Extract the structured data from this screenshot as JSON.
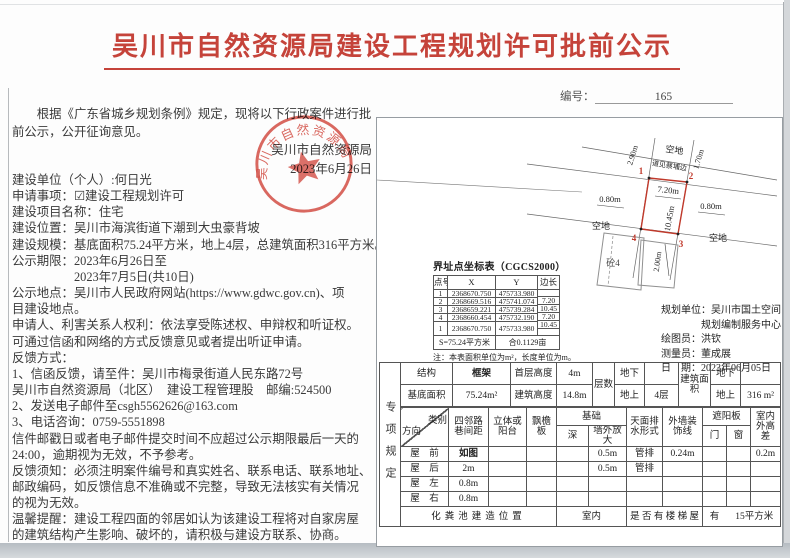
{
  "colors": {
    "title_red": "#c5433a",
    "seal_red": "#cf3a30",
    "parcel_red": "#c0392b",
    "table_line": "#555555"
  },
  "header": {
    "title": "吴川市自然资源局建设工程规划许可批前公示",
    "doc_no_label": "编号：",
    "doc_no_value": "165"
  },
  "body": {
    "intro": [
      "　　根据《广东省城乡规划条例》规定，现将以下行政案件进行批",
      "前公示，公开征询意见。"
    ],
    "signature": {
      "authority": "吴川市自然资源局",
      "date": "2023年6月26日"
    },
    "seal_arc_text": "吴川市自然资源局",
    "fields": [
      "建设单位（个人）:何日光",
      "申请事项：☑建设工程规划许可",
      "建设项目名称：住宅",
      "建设位置：吴川市海滨街道下潮到大虫豪背坡",
      "建设规模：基底面积75.24平方米，地上4层，总建筑面积316平方米。",
      "公示期限：2023年6月26日至",
      "　　　　　2023年7月5日(共10日)",
      "公示地点：吴川市人民政府网站(https://www.gdwc.gov.cn)、项",
      "目建设地点。",
      "申请人、利害关系人权利：依法享受陈述权、申辩权和听证权。",
      "可通过信函和网络的方式反馈意见或者提出听证申请。",
      "反馈方式：",
      "1、信函反馈，请至件：吴川市梅录街道人民东路72号",
      "吴川市自然资源局（北区）　建设工程管理股　邮编:524500",
      "2、发送电子邮件至csgh5562626@163.com",
      "3、电话咨询：0759-5551898",
      "信件邮戳日或者电子邮件提交时间不应超过公示期限最后一天的",
      "24:00，逾期视为无效，不予参考。",
      "反馈须知：必须注明案件编号和真实姓名、联系电话、联系地址、",
      "邮政编码，如反馈信息不准确或不完整，导致无法核实有关情况",
      "的视为无效。",
      "温馨提醒：建设工程四面的邻居如认为该建设工程将对自家房屋",
      "的建筑结构产生影响、破坏的，请积极与建设方联系、协商。"
    ]
  },
  "plan": {
    "points": [
      "1",
      "2",
      "3",
      "4"
    ],
    "dim_top_edge": "7.20m",
    "dim_right_edge": "10.45m",
    "dim_left": "0.80m",
    "dim_right": "0.80m",
    "dim_upper_left": "2.90m",
    "dim_upper_right": "1.70m",
    "dim_lower": "2.00m",
    "vacant_top": "空地",
    "vacant_left": "空地",
    "vacant_right": "空地",
    "road_label": "道见蔡埔边",
    "neighbor_building": "砼4"
  },
  "coord_table": {
    "title": "界址点坐标表（CGCS2000）",
    "headers": {
      "no": "点号",
      "x": "X",
      "y": "Y",
      "edge": "边长"
    },
    "points": [
      {
        "no": "1",
        "x": "2368670.750",
        "y": "475733.980"
      },
      {
        "no": "2",
        "x": "2368669.516",
        "y": "475741.074"
      },
      {
        "no": "3",
        "x": "2368659.221",
        "y": "475739.284"
      },
      {
        "no": "4",
        "x": "2368660.454",
        "y": "475732.190"
      },
      {
        "no": "1",
        "x": "2368670.750",
        "y": "475733.980"
      }
    ],
    "edges": [
      "7.20",
      "10.45",
      "7.20",
      "10.45"
    ],
    "area_label": "S=75.24平方米",
    "area_mu": "合0.1129亩",
    "note": "注：本表面积单位为m²，长度单位为m。"
  },
  "plan_info": {
    "line1": "规划单位：吴川市国土空间",
    "line2": "规划编制服务中心",
    "line3": "绘图员：洪钦",
    "line4": "测量员：董成展",
    "line5": "日　期：2023年06月05日"
  },
  "spec": {
    "side_label": "专项规定",
    "struct_label": "结构",
    "struct_value": "框架",
    "first_floor_label": "首层高度",
    "first_floor_value": "4m",
    "floors_label": "层数",
    "below_label": "地下",
    "above_label": "地上",
    "above_value": "4层",
    "bldg_area_label": "建筑面积",
    "area_below_label": "地下",
    "area_above_label": "地上",
    "area_above_value": "316 m²",
    "base_area_label": "基底面积",
    "base_area_value": "75.24m²",
    "bldg_height_label": "建筑高度",
    "bldg_height_value": "14.8m",
    "cat_label": "类别",
    "dir_label": "方向",
    "col_neighbor": "四邻路巷间距",
    "col_balcony": "立体或阳台",
    "col_eave": "飘檐板",
    "col_found": "基础",
    "col_depth": "深",
    "col_expand": "墙外放大",
    "col_drain": "天面排水形式",
    "col_wall": "外墙装饰线",
    "col_sunshade": "遮阳板",
    "col_door": "门",
    "col_window": "窗",
    "col_hdiff": "室内外高差",
    "rows": [
      {
        "dir": "屋　前",
        "neighbor": "如图",
        "expand": "0.5m",
        "drain": "管排",
        "wall": "0.24m",
        "hdiff": "0.2m"
      },
      {
        "dir": "屋　后",
        "neighbor": "2m",
        "expand": "0.5m",
        "drain": "管排"
      },
      {
        "dir": "屋　左",
        "neighbor": "0.8m"
      },
      {
        "dir": "屋　右",
        "neighbor": "0.8m"
      }
    ],
    "septic_label": "化粪池建造位置",
    "septic_value": "室内",
    "stair_label": "是 否 有 楼 梯 屋",
    "stair_value": "有",
    "stair_area": "15平方米"
  }
}
